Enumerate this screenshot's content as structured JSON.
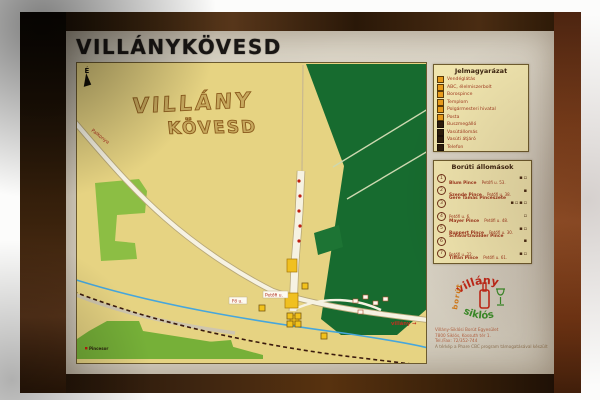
{
  "title": "VILLÁNYKÖVESD",
  "map": {
    "north_label": "É",
    "deco_name_line1": "VILLÁNY",
    "deco_name_line2": "KÖVESD",
    "labels": {
      "road_west": "Palkonya",
      "road_east": "villány →",
      "street_a": "Petőfi u.",
      "street_b": "Fő u.",
      "cellar_row": "Pincesor"
    }
  },
  "legend": {
    "title": "Jelmagyarázat",
    "items": [
      {
        "icon": "restaurant-icon",
        "label": "Vendéglátás"
      },
      {
        "icon": "grocery-icon",
        "label": "ABC, élelmiszerbolt"
      },
      {
        "icon": "wine-cellar-icon",
        "label": "Borospince"
      },
      {
        "icon": "church-icon",
        "label": "Templom"
      },
      {
        "icon": "townhall-icon",
        "label": "Polgármesteri hivatal"
      },
      {
        "icon": "post-office-icon",
        "label": "Posta"
      },
      {
        "icon": "bus-stop-icon",
        "label": "Buszmegálló"
      },
      {
        "icon": "railway-station-icon",
        "label": "Vasútállomás"
      },
      {
        "icon": "railway-crossing-icon",
        "label": "Vasúti átjáró"
      },
      {
        "icon": "phone-icon",
        "label": "Telefon"
      }
    ]
  },
  "stations": {
    "title": "Borúti állomások",
    "items": [
      {
        "num": "1",
        "name": "Blum Pince",
        "addr": "Petőfi u. 53.",
        "icons": "▪▫"
      },
      {
        "num": "2",
        "name": "Szende Pince",
        "addr": "Petőfi u. 38.",
        "icons": "▪"
      },
      {
        "num": "3",
        "name": "Gere Tamás Pincészete",
        "addr": "Petőfi u. 6.",
        "icons": "▪▫▪▫"
      },
      {
        "num": "4",
        "name": "Mayer Pince",
        "addr": "Petőfi u. 48.",
        "icons": "▫"
      },
      {
        "num": "5",
        "name": "Ruppert Pince",
        "addr": "Petőfi u. 30.",
        "icons": "▪▫"
      },
      {
        "num": "6",
        "name": "Schwartzwalder Pince",
        "addr": "Petőfi u. 22.",
        "icons": "▪"
      },
      {
        "num": "7",
        "name": "Tiffán Pince",
        "addr": "Petőfi u. 61.",
        "icons": "▪▫"
      }
    ]
  },
  "logo": {
    "arc_top": "villány",
    "arc_bottom": "siklós",
    "side": "borút"
  },
  "contact": {
    "line1": "Villány-Siklósi Borút Egyesület",
    "line2": "7800 Siklós, Kossuth tér 1.",
    "line3": "Tel./Fax: 72/352-744",
    "line4": "A térkép a Phare CBC program támogatásával készült"
  },
  "colors": {
    "map_background": "#e6d382",
    "forest_green": "#176b2f",
    "field_green": "#7fb83e",
    "stream_blue": "#46a6dc",
    "frame_brown": "#3a2008",
    "accent_red": "#a03a20",
    "poi_yellow": "#f2c21a"
  }
}
